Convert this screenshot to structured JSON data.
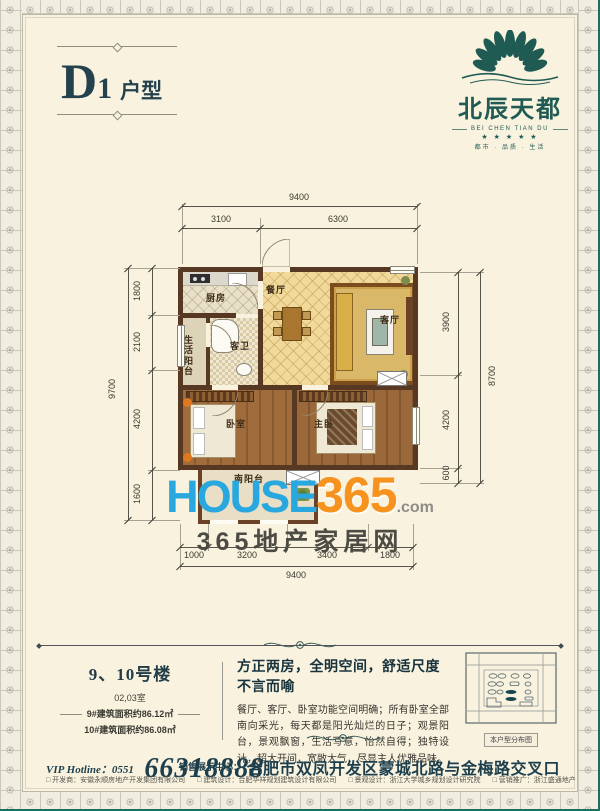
{
  "header": {
    "unit_code": "D",
    "unit_num": "1",
    "unit_suffix": "户型"
  },
  "logo": {
    "name_zh": "北辰天都",
    "name_en": "BEI CHEN TIAN DU",
    "stars": "★ ★ ★ ★ ★",
    "tagline": "都市 · 品质 · 生活"
  },
  "floorplan": {
    "rooms": {
      "kitchen": "厨房",
      "dining": "餐厅",
      "living": "客厅",
      "life_balcony": "生活阳台",
      "guest_bath": "客卫",
      "bedroom": "卧室",
      "master": "主卧",
      "south_balcony": "南阳台"
    },
    "dims": {
      "top_total": "9400",
      "top_segs": [
        "3100",
        "6300"
      ],
      "left_total": "9700",
      "left_segs": [
        "1800",
        "2100",
        "4200",
        "1600"
      ],
      "right_total": "8700",
      "right_segs": [
        "3900",
        "4200",
        "600"
      ],
      "bottom_total": "9400",
      "bottom_segs": [
        "1000",
        "3200",
        "3400",
        "1800"
      ]
    }
  },
  "watermark": {
    "word": "HOUSE",
    "num": "365",
    "dotcom": ".com",
    "site_name": "365地产家居网"
  },
  "details": {
    "building_title": "9、10号楼",
    "room_line": "02,03室",
    "area_line_1": "9#建筑面积约86.12㎡",
    "area_line_2": "10#建筑面积约86.08㎡",
    "headline": "方正两房，全明空间，舒适尺度不言而喻",
    "body": "餐厅、客厅、卧室功能空间明确；所有卧室全部南向采光，每天都是阳光灿烂的日子；观景阳台，景观飘窗，生活写意，怡然自得；独特设计，超大开间，宽敞大气，尽显主人优雅品味。",
    "minimap_label": "本户型分布图"
  },
  "footer": {
    "hotline_label": "VIP Hotline：0551",
    "hotline_number": "66318888",
    "sales_label": "销售展示中心：",
    "address": "合肥市双凤开发区蒙城北路与金梅路交叉口",
    "credits": [
      "□ 开发商：安徽永顺房地产开发集团有限公司",
      "□ 建筑设计：合肥华祥规划建筑设计有限公司",
      "□ 景观设计：浙江大学城乡规划设计研究院",
      "□ 营销推广：浙江盛通地产"
    ]
  },
  "colors": {
    "accent_teal": "#1d4e57",
    "wall_brown": "#573822",
    "watermark_blue": "#29a8df",
    "watermark_orange": "#f6921e",
    "paper": "#f9f2df"
  }
}
